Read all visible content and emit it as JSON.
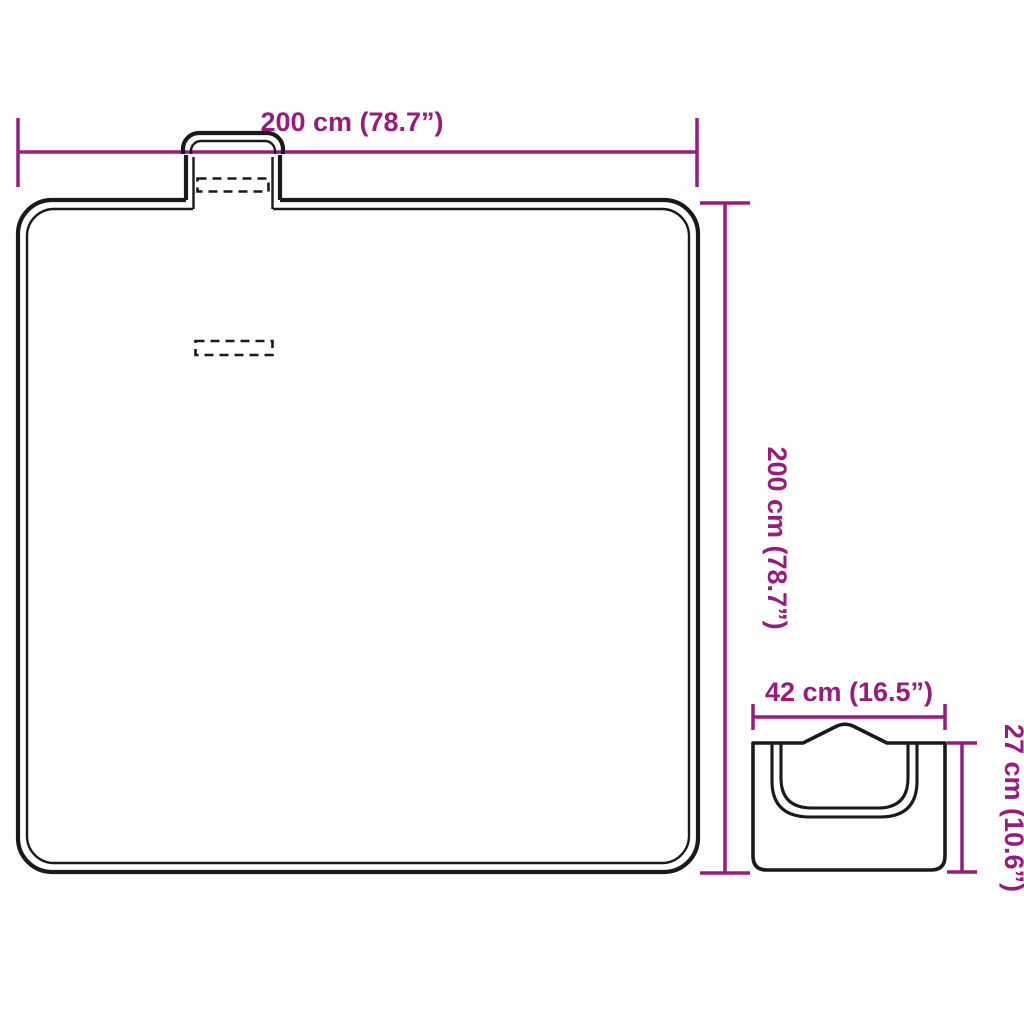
{
  "diagram": {
    "title": "picnic-blanket-dimension-diagram",
    "colors": {
      "background": "#ffffff",
      "outline": "#1a1a1a",
      "dimension": "#981b7d"
    },
    "unfolded": {
      "name": "blanket unfolded with carry handle",
      "width_label": "200 cm (78.7”)",
      "height_label": "200 cm (78.7”)"
    },
    "folded": {
      "name": "blanket folded into carry bag",
      "width_label": "42 cm (16.5”)",
      "height_label": "27 cm (10.6”)"
    }
  }
}
